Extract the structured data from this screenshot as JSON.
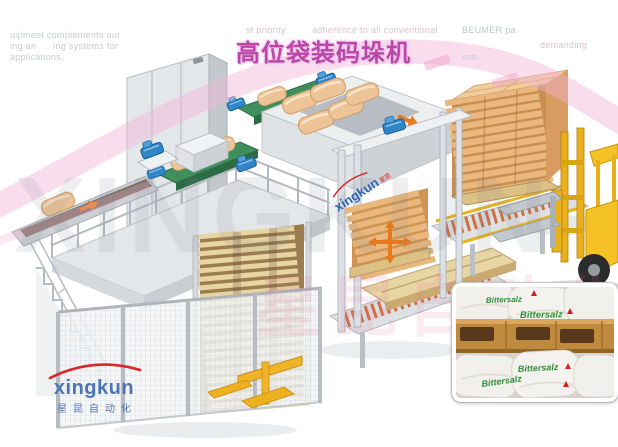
{
  "title": {
    "text": "高位袋装码垛机"
  },
  "header_fragments": {
    "tl1": "uipment complements our",
    "tl2": "ing an      ing systems for",
    "tl3": "applications.",
    "tr1": "st priority",
    "tr2": "adherence to all conventional",
    "tr3": "BEUMER pa",
    "tr4": "demanding",
    "tr5": "con..."
  },
  "watermark": {
    "brand_latin": "XINGKUN",
    "brand_cn": "星昆自动化",
    "machine_mark_latin": "xingkun",
    "machine_mark_cn": "星昆"
  },
  "logo": {
    "name": "xingkun",
    "caption_cn": "星昆自动化"
  },
  "inset_photo": {
    "bag_label": "Bittersalz"
  },
  "colors": {
    "title_magenta": "#b847a7",
    "swoosh_pink": "#f1b4d8",
    "logo_blue": "#4e73b2",
    "logo_arc_red": "#d8262c",
    "bag_label_green": "#2e8f3c",
    "belt_green": "#3f8f5c",
    "bag_tan": "#ecc497",
    "pallet_wood": "#e6d2a2",
    "roller_orange": "#cf7040",
    "forklift_yellow": "#f4c226",
    "motor_blue": "#2f86c8",
    "arrow_orange": "#e87a1e",
    "machine_grey": "#e2e5e8"
  }
}
